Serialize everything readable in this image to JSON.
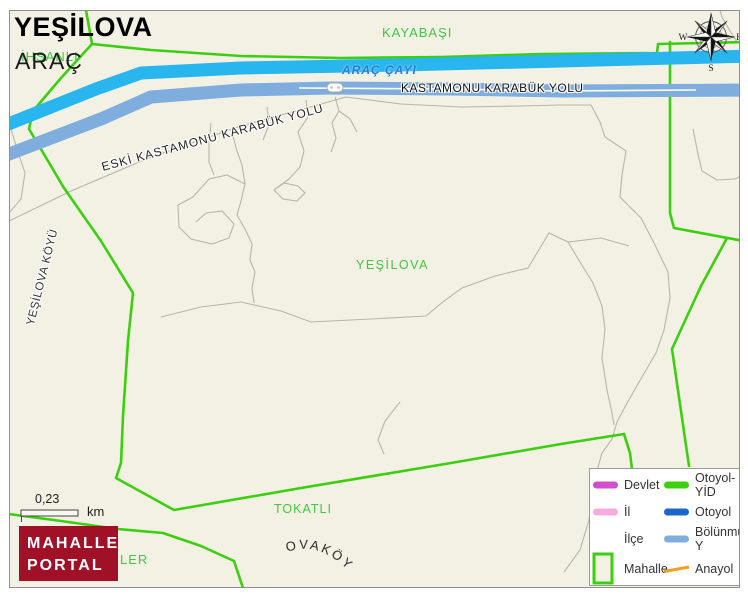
{
  "title": {
    "name": "YEŞİLOVA",
    "district": "ARAÇ"
  },
  "map_labels": {
    "partial_under_title": "İHSANLI",
    "neighbor_top": "KAYABAŞI",
    "river": "ARAÇ ÇAYI",
    "road_main": "KASTAMONU KARABÜK YOLU",
    "road_old": "ESKİ KASTAMONU KARABÜK YOLU",
    "area_center": "YEŞİLOVA",
    "village_left": "YEŞİLOVA KÖYÜ",
    "neighbor_bottom": "TOKATLI",
    "village_bottom": "OVAKÖYÜ",
    "partial_bottom_left": "LER"
  },
  "compass": {
    "n": "N",
    "w": "W",
    "e": "E",
    "s": "S"
  },
  "scale": {
    "value": "0,23",
    "unit": "km"
  },
  "logo": {
    "line1": "MAHALLE",
    "line2": "PORTAL"
  },
  "legend": {
    "items": [
      {
        "label": "Devlet",
        "color": "#cf4fcf",
        "type": "line"
      },
      {
        "label": "Otoyol-YİD",
        "color": "#3bcf10",
        "type": "line"
      },
      {
        "label": "İl",
        "color": "#f7aadc",
        "type": "line"
      },
      {
        "label": "Otoyol",
        "color": "#1a66cc",
        "type": "line"
      },
      {
        "label": "İlçe",
        "color": "",
        "type": "line"
      },
      {
        "label": "Bölünmüş Y",
        "color": "#7faddd",
        "type": "line"
      },
      {
        "label": "Mahalle",
        "color": "#3bcf10",
        "type": "area"
      },
      {
        "label": "Anayol",
        "color": "#f0a01e",
        "type": "line"
      }
    ]
  },
  "colors": {
    "map_background": "#f2f1e3",
    "river": "#29b5ee",
    "divided_road": "#7faddd",
    "boundary_green": "#3bcf10",
    "minor_road_gray": "#b7b6aa",
    "water_label_blue": "#1f7fd4",
    "place_label_green": "#44c544",
    "logo_background": "#a01128"
  }
}
